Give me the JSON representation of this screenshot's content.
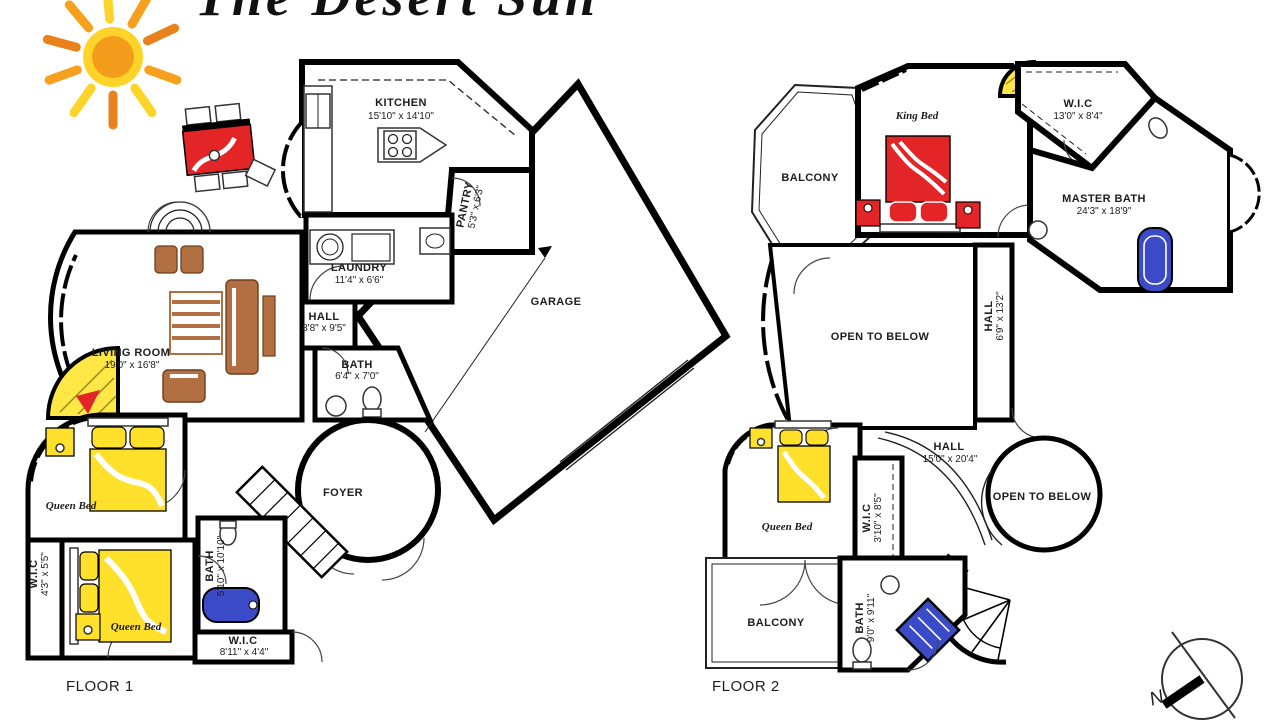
{
  "title": "The Desert Sun",
  "floor1": {
    "label": "FLOOR 1",
    "rooms": {
      "kitchen": {
        "name": "KITCHEN",
        "dims": "15'10\" x 14'10\""
      },
      "pantry": {
        "name": "PANTRY",
        "dims": "5'3\" x 6'3\""
      },
      "laundry": {
        "name": "LAUNDRY",
        "dims": "11'4\" x 6'6\""
      },
      "hall": {
        "name": "HALL",
        "dims": "8'8\" x 9'5\""
      },
      "bath": {
        "name": "BATH",
        "dims": "6'4\" x 7'0\""
      },
      "garage": {
        "name": "GARAGE"
      },
      "living_room": {
        "name": "LIVING ROOM",
        "dims": "19'0\" x 16'8\""
      },
      "foyer": {
        "name": "FOYER"
      },
      "bedroom1": {
        "bed": "Queen Bed"
      },
      "wic1": {
        "name": "W.I.C",
        "dims": "4'3\" x 5'5\""
      },
      "bedroom2": {
        "bed": "Queen Bed"
      },
      "bath2": {
        "name": "BATH",
        "dims": "5'10\" x 10'10\""
      },
      "wic2": {
        "name": "W.I.C",
        "dims": "8'11\" x 4'4\""
      }
    }
  },
  "floor2": {
    "label": "FLOOR 2",
    "rooms": {
      "balcony_top": {
        "name": "BALCONY"
      },
      "master_bedroom": {
        "bed": "King Bed"
      },
      "wic": {
        "name": "W.I.C",
        "dims": "13'0\" x 8'4\""
      },
      "master_bath": {
        "name": "MASTER BATH",
        "dims": "24'3\" x 18'9\""
      },
      "hall_upper": {
        "name": "HALL",
        "dims": "6'9\" x 13'2\""
      },
      "open_to_below_1": {
        "name": "OPEN TO BELOW"
      },
      "hall": {
        "name": "HALL",
        "dims": "15'0\" x 20'4\""
      },
      "open_to_below_2": {
        "name": "OPEN TO BELOW"
      },
      "bedroom3": {
        "bed": "Queen Bed"
      },
      "wic2": {
        "name": "W.I.C",
        "dims": "3'10\" x 8'5\""
      },
      "balcony_bottom": {
        "name": "BALCONY"
      },
      "bath": {
        "name": "BATH",
        "dims": "9'0\" x 9'11\""
      }
    }
  },
  "compass": {
    "north": "N"
  },
  "colors": {
    "bed_yellow": "#FFE12B",
    "accent_red": "#E42528",
    "tub_blue": "#3B4BC8",
    "wood_tan": "#B26F42",
    "sun_orange": "#F6A01E",
    "sun_deep_orange": "#E8821C",
    "sun_yellow": "#FFD428",
    "walls": "#000000"
  }
}
